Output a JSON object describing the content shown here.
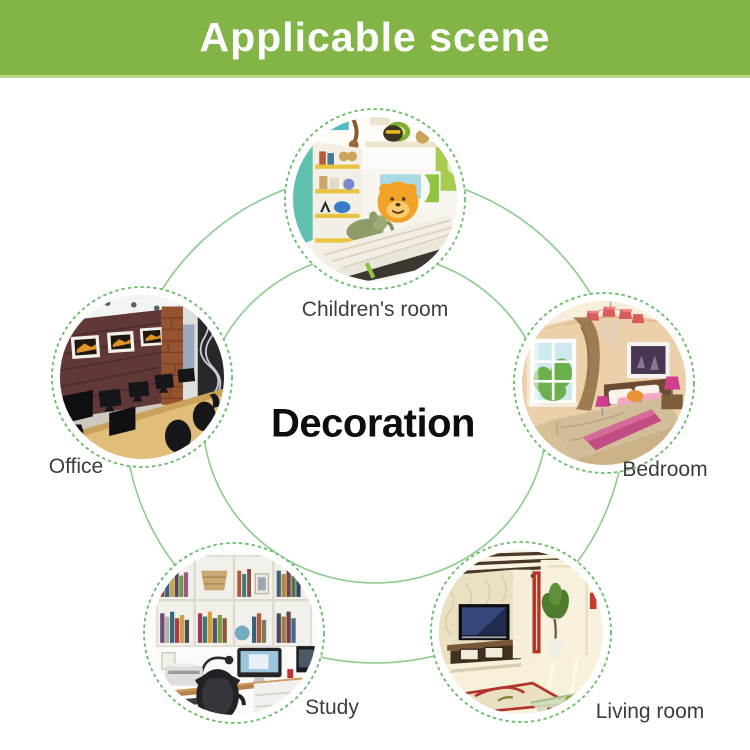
{
  "banner": {
    "title": "Applicable scene"
  },
  "center_label": "Decoration",
  "scenes": [
    {
      "id": "childrens-room",
      "label": "Children's room"
    },
    {
      "id": "office",
      "label": "Office"
    },
    {
      "id": "bedroom",
      "label": "Bedroom"
    },
    {
      "id": "study",
      "label": "Study"
    },
    {
      "id": "living-room",
      "label": "Living room"
    }
  ],
  "colors": {
    "banner_green": "#83b546",
    "banner_bottom_edge": "#bcd88e",
    "connector_line_green": "#8ccb8b",
    "dashed_ring_green": "#67bd67",
    "label_gray": "#3d3d3d",
    "banner_text": "#ffffff",
    "center_text": "#0d0d0d"
  }
}
